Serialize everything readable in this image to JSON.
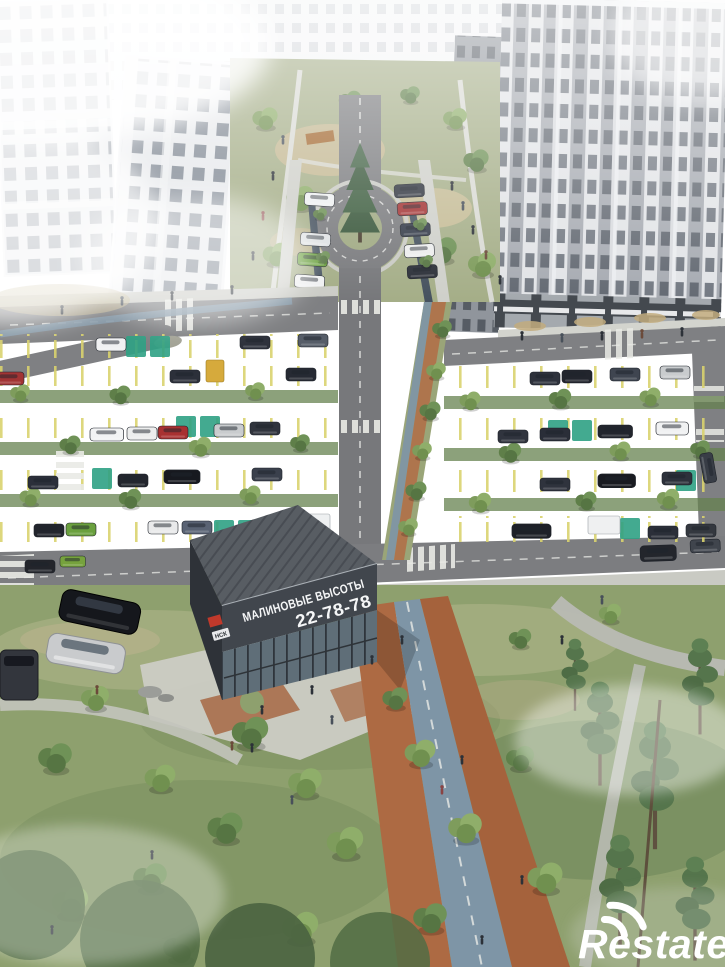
{
  "scene_title": "Aerial render of residential complex with parking, park and sales office",
  "sales_office": {
    "sign_line1": "МАЛИНОВЫЕ ВЫСОТЫ",
    "sign_line2": "22-78-78",
    "corner_badge": "НСК"
  },
  "watermark": {
    "brand": "Restate"
  },
  "palette": {
    "building_white": "#e8e9ec",
    "building_window": "#7e8692",
    "asphalt": "#85868a",
    "road_dark": "#7a7b7e",
    "parking_line_yellow": "#d9d26e",
    "eco_stall_green": "#2fa184",
    "grass": "#8ea06e",
    "tree_green": "#6f8f56",
    "pine_green": "#55754c",
    "brick_path": "#ad6a43",
    "bike_lane_blue": "#7e95a6",
    "office_dark": "#41464d",
    "office_roof": "#585d63",
    "logo_red": "#c0392b",
    "sign_text": "#f5f6f7",
    "watermark_white": "#ffffff"
  }
}
